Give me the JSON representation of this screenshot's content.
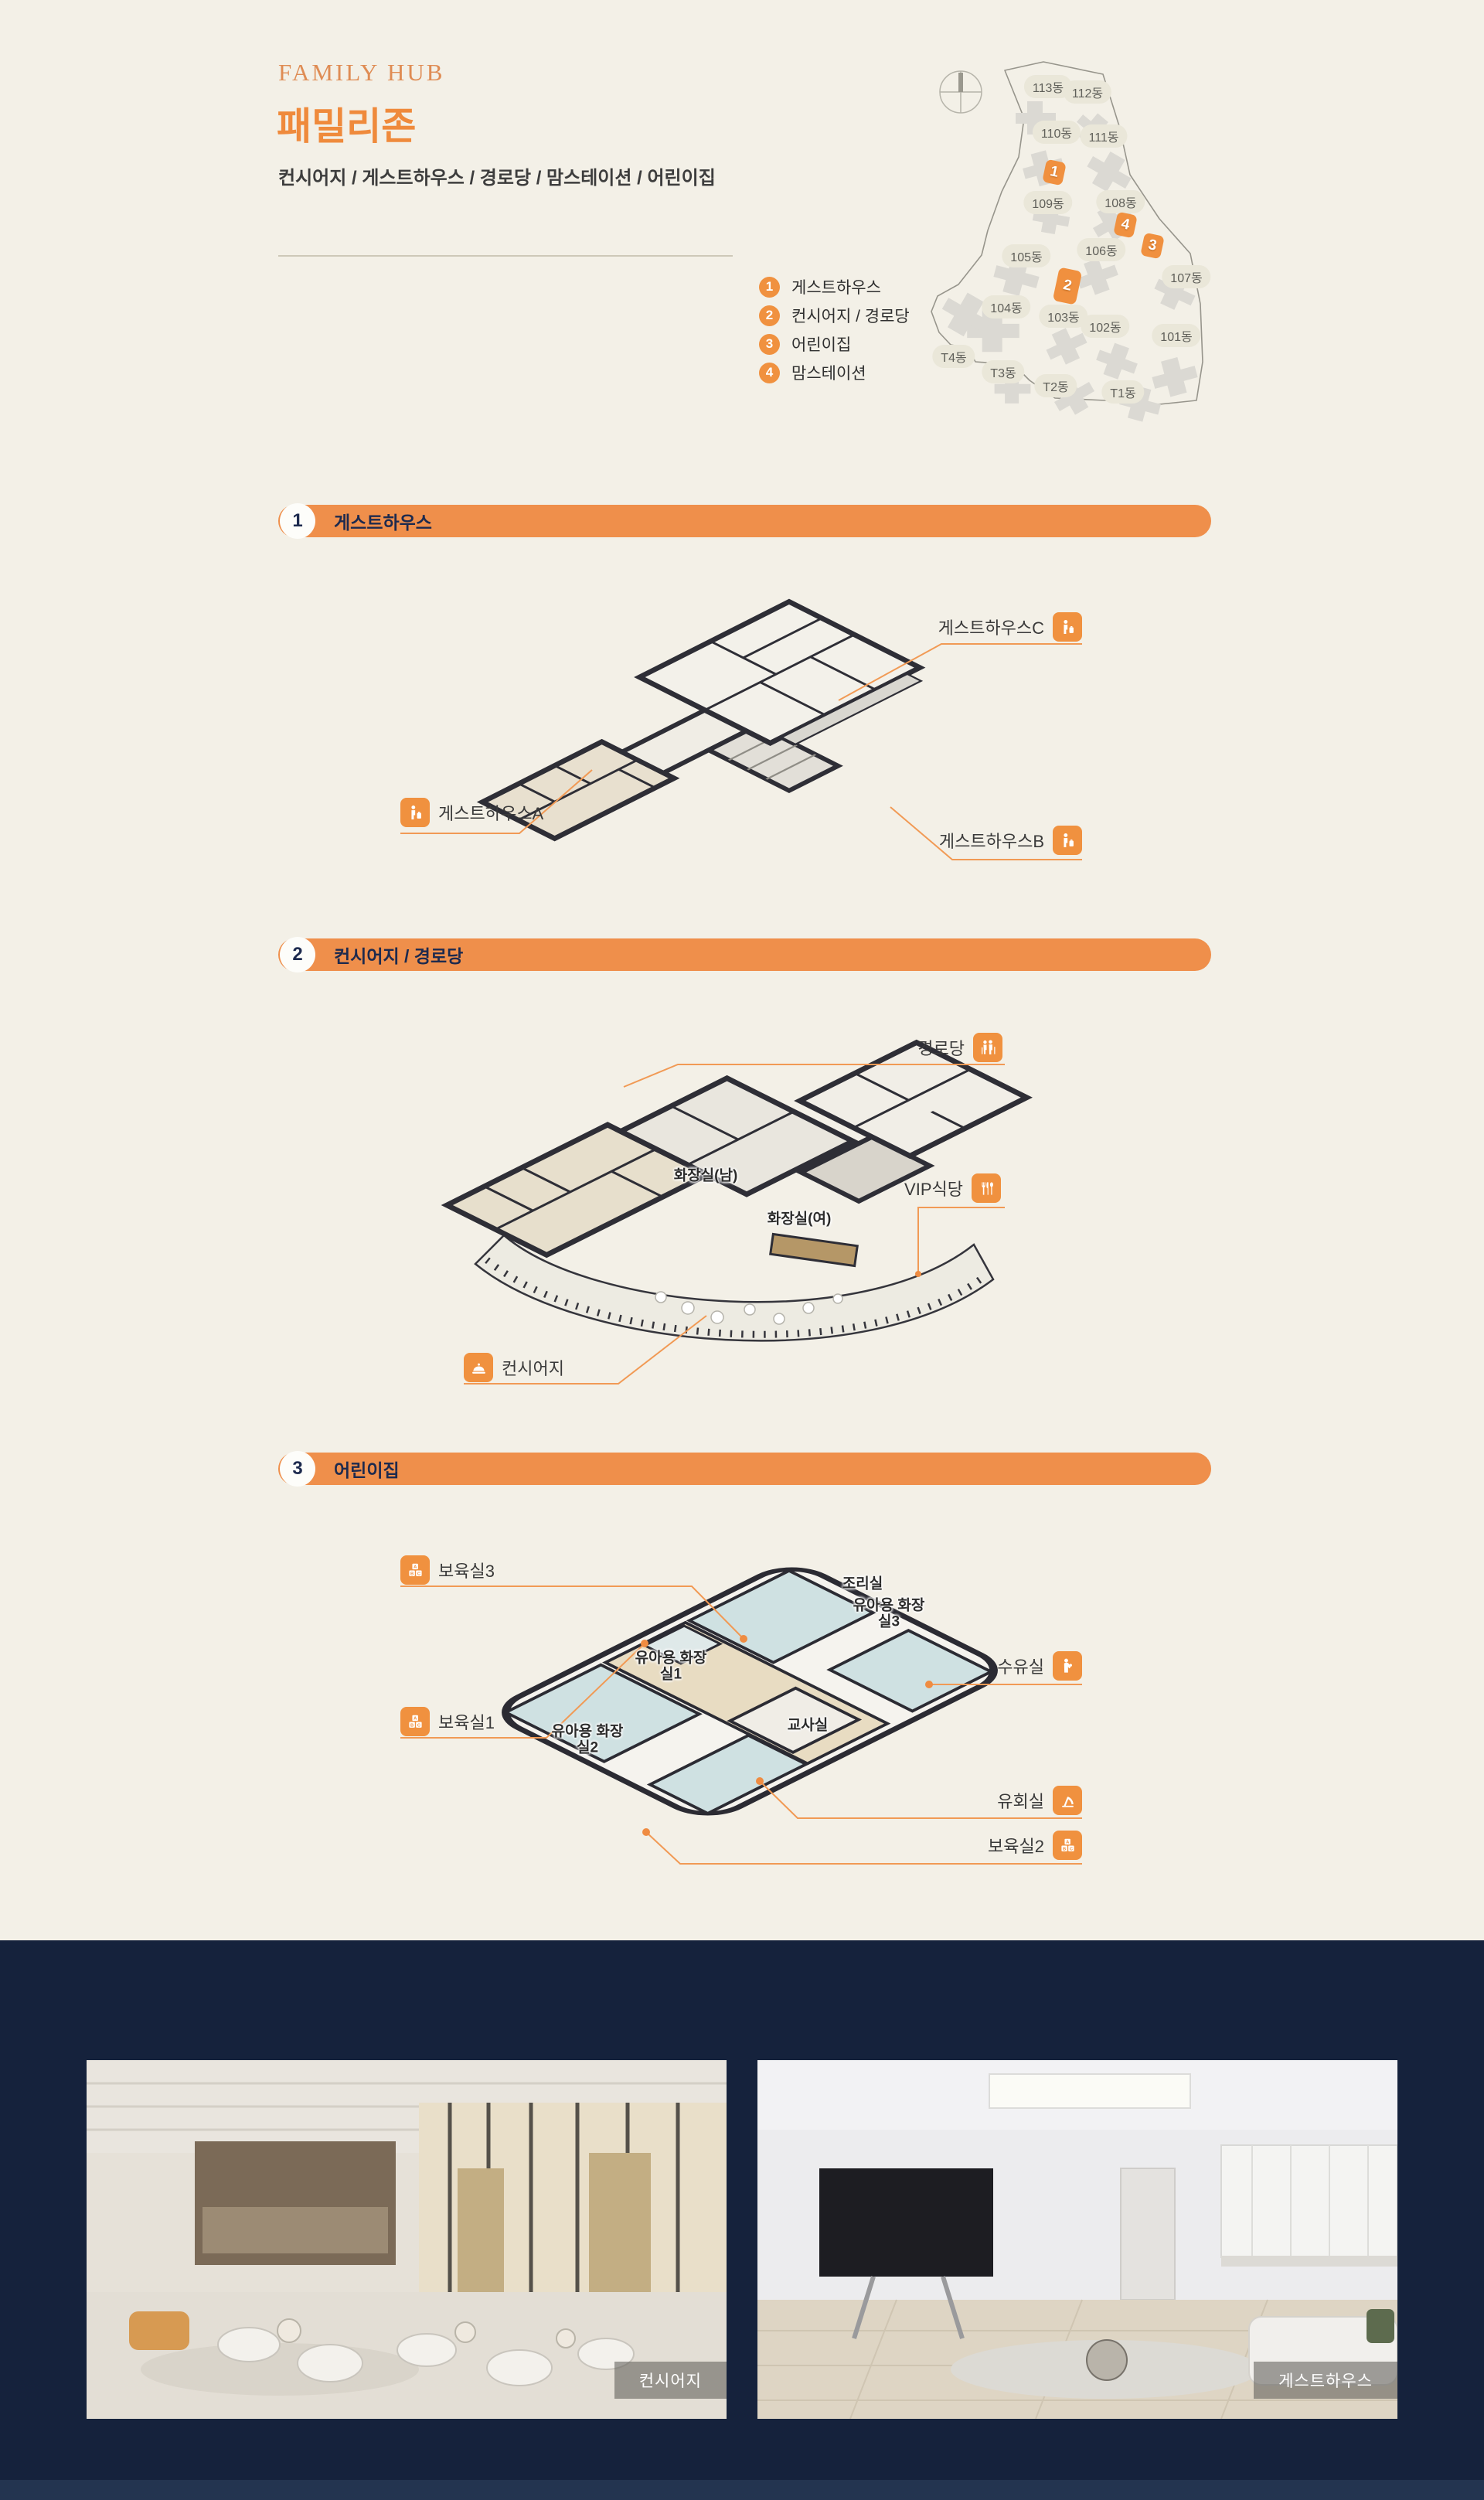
{
  "colors": {
    "background": "#f3f0e7",
    "accent": "#ef8f4b",
    "navy": "#15223c"
  },
  "header": {
    "eyebrow": "FAMILY HUB",
    "title": "패밀리존",
    "subtitle": "컨시어지 / 게스트하우스 / 경로당 / 맘스테이션 / 어린이집"
  },
  "legend": {
    "items": [
      {
        "num": "1",
        "label": "게스트하우스"
      },
      {
        "num": "2",
        "label": "컨시어지 / 경로당"
      },
      {
        "num": "3",
        "label": "어린이집"
      },
      {
        "num": "4",
        "label": "맘스테이션"
      }
    ]
  },
  "map": {
    "compass_icon": "compass-icon",
    "buildings": [
      "113동",
      "112동",
      "110동",
      "111동",
      "109동",
      "108동",
      "105동",
      "106동",
      "107동",
      "104동",
      "103동",
      "102동",
      "101동",
      "T4동",
      "T3동",
      "T2동",
      "T1동"
    ],
    "markers": [
      "1",
      "2",
      "3",
      "4"
    ]
  },
  "sections": [
    {
      "num": "1",
      "title": "게스트하우스",
      "labels": {
        "a": "게스트하우스A",
        "b": "게스트하우스B",
        "c": "게스트하우스C"
      },
      "icon": "traveler-icon"
    },
    {
      "num": "2",
      "title": "컨시어지 / 경로당",
      "labels": {
        "senior": "경로당",
        "vip": "VIP식당",
        "concierge": "컨시어지"
      },
      "icons": {
        "senior": "seniors-icon",
        "vip": "cutlery-icon",
        "concierge": "bell-icon"
      },
      "rooms": {
        "toilet_m": "화장실(남)",
        "toilet_f": "화장실(여)"
      }
    },
    {
      "num": "3",
      "title": "어린이집",
      "labels": {
        "nursery3": "보육실3",
        "nursing": "수유실",
        "nursery1": "보육실1",
        "play": "유회실",
        "nursery2": "보육실2"
      },
      "icons": {
        "nursery": "abc-blocks-icon",
        "nursing": "nursing-icon",
        "play": "slide-icon"
      },
      "rooms": {
        "kitchen": "조리실",
        "kid_toilet3": "유아용 화장실3",
        "kid_toilet1": "유아용 화장실1",
        "kid_toilet2": "유아용 화장실2",
        "teacher": "교사실"
      }
    }
  ],
  "photos": [
    {
      "caption": "컨시어지"
    },
    {
      "caption": "게스트하우스"
    }
  ]
}
